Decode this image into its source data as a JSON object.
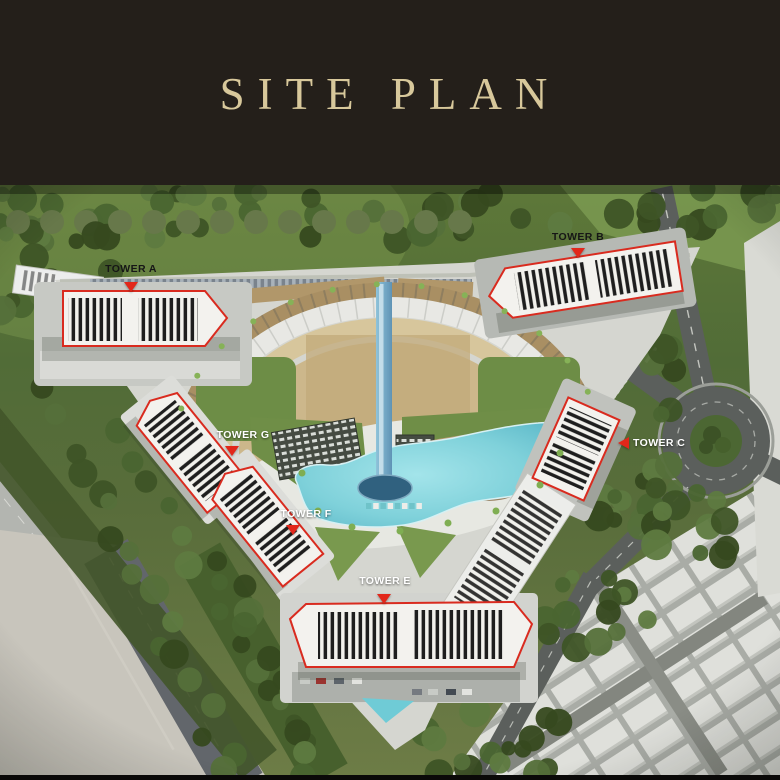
{
  "header": {
    "title": "SITE PLAN"
  },
  "site_plan": {
    "towers": [
      {
        "id": "A",
        "label": "TOWER A",
        "marker": "down",
        "label_color": "#161616"
      },
      {
        "id": "B",
        "label": "TOWER B",
        "marker": "down",
        "label_color": "#161616"
      },
      {
        "id": "C",
        "label": "TOWER C",
        "marker": "left",
        "label_color": "#ffffff"
      },
      {
        "id": "E",
        "label": "TOWER E",
        "marker": "down",
        "label_color": "#ffffff"
      },
      {
        "id": "F",
        "label": "TOWER F",
        "marker": "down",
        "label_color": "#ffffff"
      },
      {
        "id": "G",
        "label": "TOWER G",
        "marker": "down",
        "label_color": "#ffffff"
      }
    ],
    "colors": {
      "header_background": "#241f1a",
      "title_gold": "#d8c89b",
      "tower_outline_red": "#d92b1f",
      "marker_red": "#e2271a",
      "pool_water": "#7fd1da"
    }
  }
}
